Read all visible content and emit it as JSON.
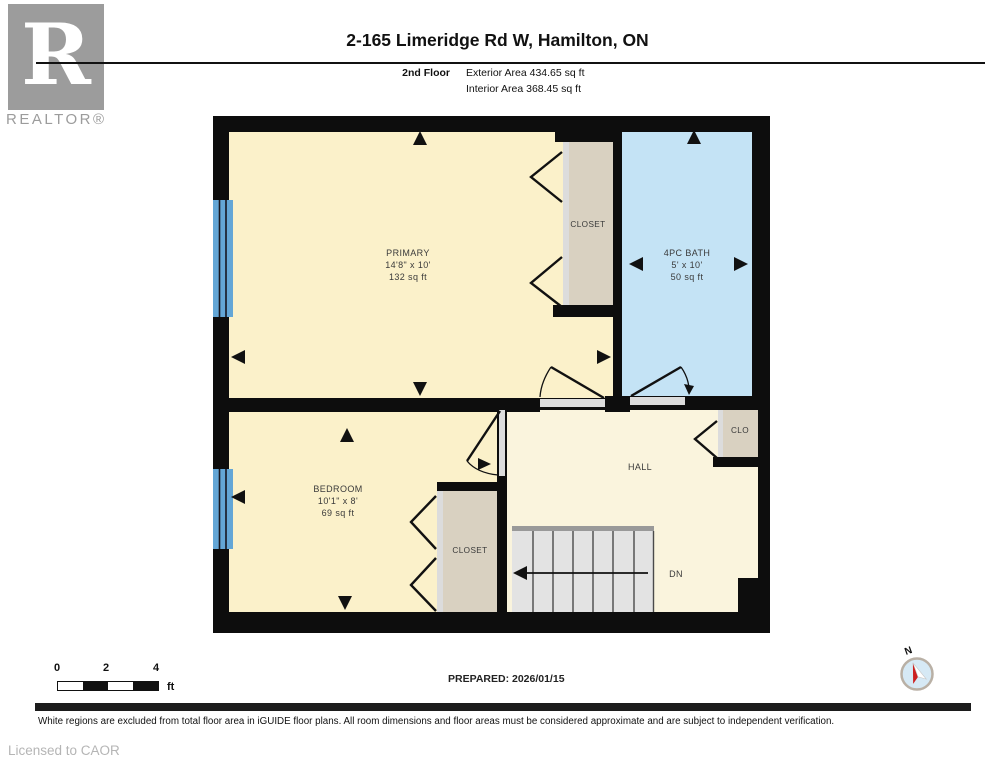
{
  "header": {
    "logo_letter": "R",
    "logo_brand": "REALTOR®",
    "title": "2-165 Limeridge Rd W, Hamilton, ON",
    "floor_label": "2nd Floor",
    "exterior_area": "Exterior Area 434.65 sq ft",
    "interior_area": "Interior Area 368.45 sq ft"
  },
  "floorplan": {
    "rooms": {
      "primary": {
        "name": "PRIMARY",
        "dims": "14'8\" x 10'",
        "area": "132 sq ft"
      },
      "bedroom": {
        "name": "BEDROOM",
        "dims": "10'1\" x 8'",
        "area": "69 sq ft"
      },
      "bath": {
        "name": "4PC BATH",
        "dims": "5' x 10'",
        "area": "50 sq ft"
      },
      "hall": {
        "name": "HALL"
      },
      "closet_top": {
        "name": "CLOSET"
      },
      "closet_bottom": {
        "name": "CLOSET"
      },
      "clo": {
        "name": "CLO"
      },
      "stairs_down": {
        "name": "DN"
      }
    },
    "colors": {
      "wall": "#0d0d0d",
      "room": "#fbf1ca",
      "hall": "#faf4dd",
      "closet": "#d9d1c1",
      "door_track": "#dcdcdc",
      "bath": "#c4e3f5",
      "window": "#63a6d6",
      "stairs": "#e3e3e3"
    }
  },
  "scale_bar": {
    "tick0": "0",
    "tick1": "2",
    "tick2": "4",
    "unit": "ft"
  },
  "compass": {
    "north": "N"
  },
  "footer": {
    "prepared": "PREPARED: 2026/01/15",
    "disclaimer": "White regions are excluded from total floor area in iGUIDE floor plans. All room dimensions and floor areas must be considered approximate and are subject to independent verification.",
    "license": "Licensed to CAOR"
  }
}
